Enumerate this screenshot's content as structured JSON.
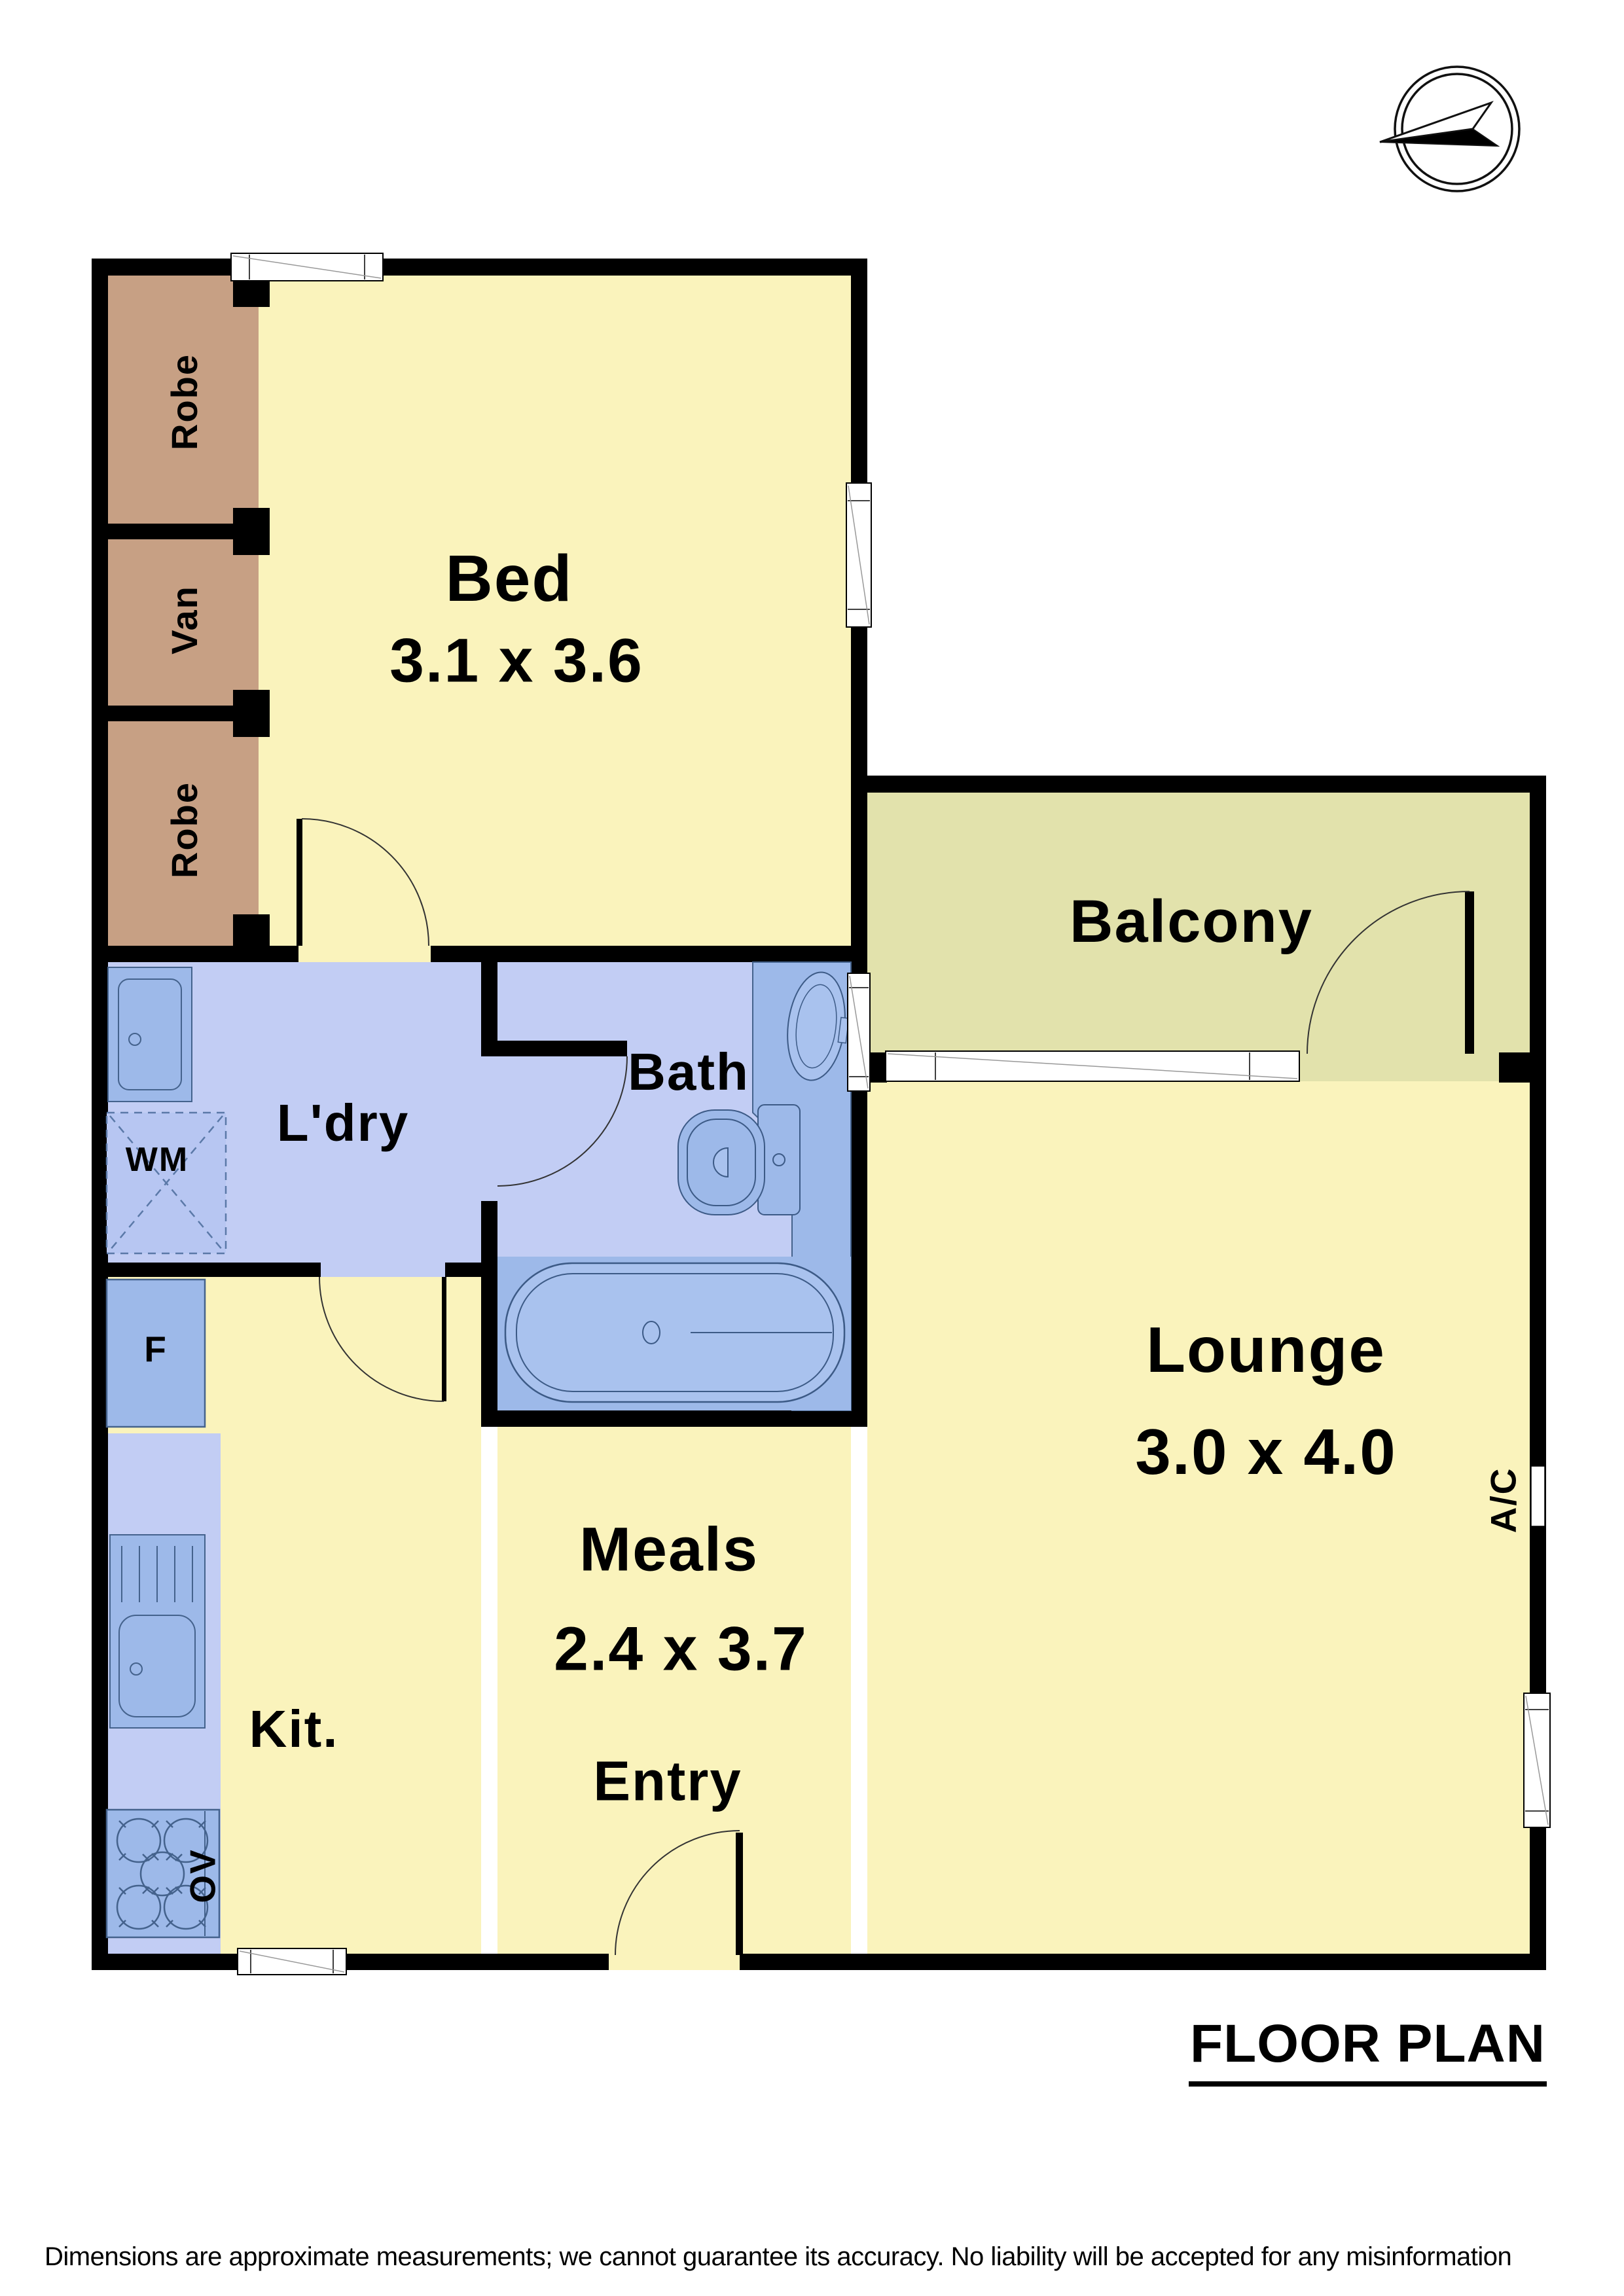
{
  "title": {
    "text": "FLOOR PLAN"
  },
  "disclaimer": "Dimensions are approximate measurements; we cannot guarantee its accuracy. No liability will be accepted for any misinformation",
  "rooms": {
    "bed": {
      "label": "Bed",
      "dims": "3.1 x 3.6"
    },
    "balcony": {
      "label": "Balcony"
    },
    "lounge": {
      "label": "Lounge",
      "dims": "3.0 x 4.0"
    },
    "meals": {
      "label": "Meals",
      "dims": "2.4 x 3.7"
    },
    "entry": {
      "label": "Entry"
    },
    "kitchen": {
      "label": "Kit."
    },
    "laundry": {
      "label": "L'dry"
    },
    "bath": {
      "label": "Bath"
    }
  },
  "closets": {
    "robe_top": "Robe",
    "vanity": "Van",
    "robe_bottom": "Robe"
  },
  "fixtures": {
    "washing_machine": "WM",
    "fridge": "F",
    "oven": "OV",
    "air_conditioner": "A/C"
  },
  "colors": {
    "wall": "#000000",
    "room_yellow": "#FAF3BC",
    "balcony_olive": "#E2E2AC",
    "wet_blue": "#C2CDF4",
    "fixture_blue": "#9DB9E9",
    "fixture_blue_light": "#A9C2EE",
    "fixture_stroke": "#44628C",
    "robe_brown": "#C7A084"
  }
}
